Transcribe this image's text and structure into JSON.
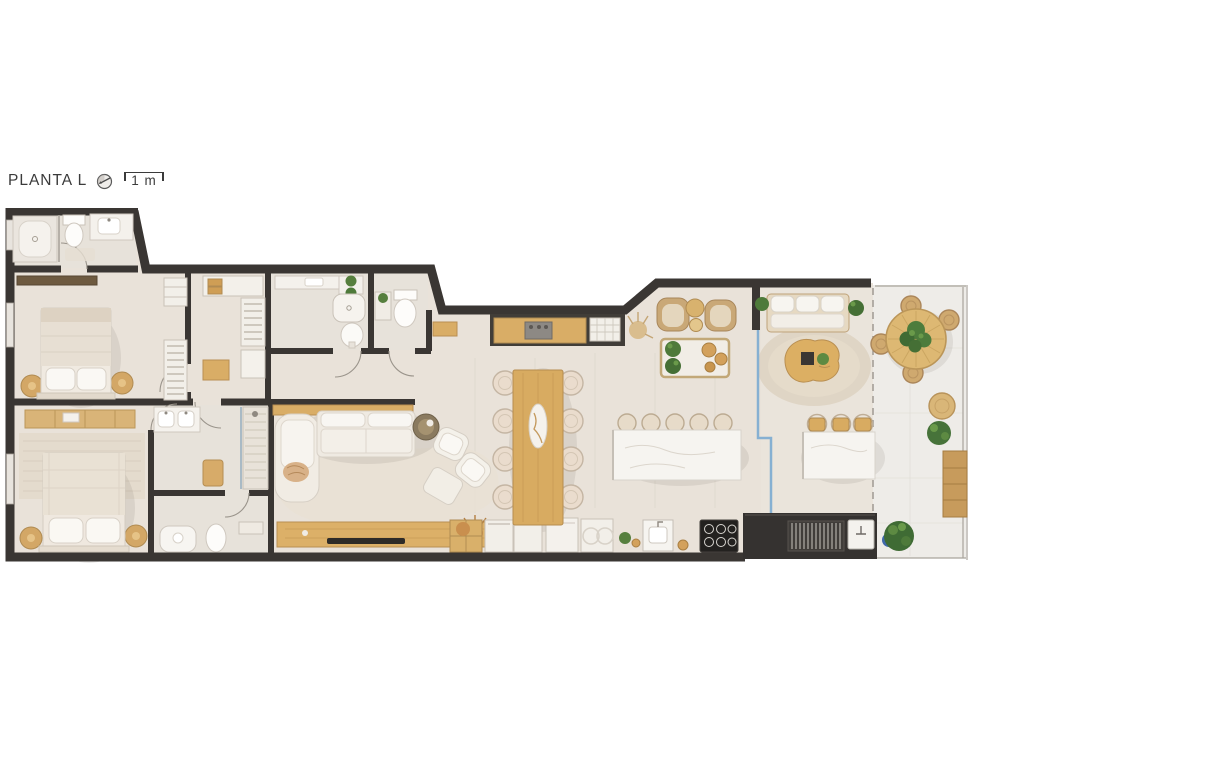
{
  "header": {
    "title": "PLANTA L",
    "scale_label": "1 m",
    "icons": [
      "north-arrow-icon",
      "scale-bar-bracket"
    ]
  },
  "plan": {
    "kind": "apartment-floor-plan-top-view",
    "rooms": [
      "ensuite-bathroom",
      "bedroom",
      "master-bedroom",
      "master-bathroom",
      "toilet",
      "closet-corridor",
      "social-bathroom",
      "powder-room",
      "hall",
      "kitchen",
      "dining-area",
      "living-room",
      "gourmet-lounge",
      "covered-terrace",
      "barbecue-area",
      "open-terrace"
    ],
    "furniture": [
      "double-bed",
      "master-bed",
      "nightstands",
      "wardrobes",
      "toilets",
      "sinks",
      "shower",
      "sofa",
      "chaise",
      "armchairs",
      "coffee-tables",
      "tv-console",
      "dining-table-8-chairs",
      "kitchen-counter",
      "cooktop",
      "island-5-stools",
      "bar-island-3-stools",
      "grill",
      "outdoor-sofa",
      "round-rug",
      "round-terrace-table-4-chairs",
      "tree",
      "bench",
      "potted-plants"
    ],
    "colors": {
      "wall": "#3a3633",
      "floor": "#e9e2d9",
      "bathroom_floor": "#e7e2da",
      "terrace_floor": "#eeece8",
      "wood": "#d8ab61",
      "wood_dark": "#b98f52",
      "upholstery": "#f2eee7",
      "marble": "#f6f4f0",
      "plant_green": "#4e7a3a",
      "glass_blue": "#86b0d2",
      "grill_counter": "#353230",
      "title_text": "#3b3b3b"
    }
  }
}
